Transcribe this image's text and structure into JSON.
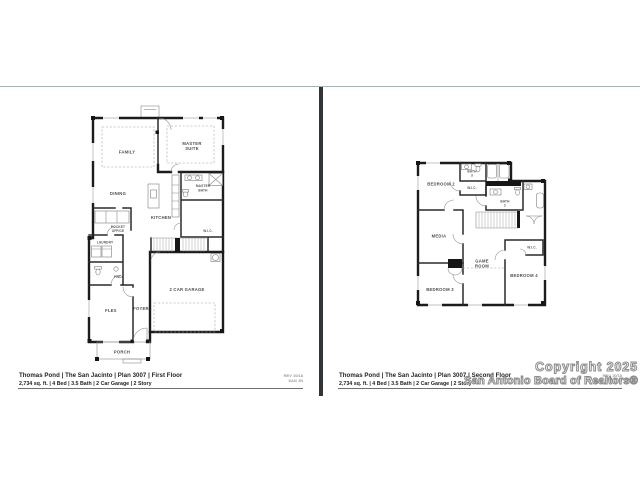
{
  "page": {
    "background": "#ffffff",
    "top_rule_color": "#a8b2b5",
    "divider_color": "#323537"
  },
  "watermark": {
    "line1": "Copyright 2025",
    "line2": "San Antonio Board of Realtors®"
  },
  "first_floor": {
    "footer": {
      "title": "Thomas Pond | The San Jacinto | Plan 3007 | First Floor",
      "specs": "2,734 sq. ft. | 4 Bed | 3.5 Bath | 2 Car Garage | 2 Story",
      "rev_line1": "REV 10/18",
      "rev_line2": "SAN JN"
    },
    "rooms": {
      "family": "FAMILY",
      "master_suite_l1": "MASTER",
      "master_suite_l2": "SUITE",
      "dining": "DINING",
      "kitchen": "KITCHEN",
      "master_bath_l1": "MASTER",
      "master_bath_l2": "BATH",
      "wic": "W.I.C.",
      "pocket_office_l1": "POCKET",
      "pocket_office_l2": "OFFICE",
      "laundry": "LAUNDRY",
      "powder": "PWDR",
      "flex": "FLEX",
      "foyer": "FOYER",
      "garage": "2 CAR GARAGE",
      "porch": "PORCH"
    }
  },
  "second_floor": {
    "footer": {
      "title": "Thomas Pond | The San Jacinto | Plan 3007 | Second Floor",
      "specs": "2,734 sq. ft. | 4 Bed | 3.5 Bath | 2 Car Garage | 2 Story",
      "rev_line1": "REV 10/18",
      "rev_line2": "SAN JN"
    },
    "rooms": {
      "bedroom2": "BEDROOM 2",
      "bath3_l1": "BATH",
      "bath3_l2": "3",
      "wic_top": "W.I.C.",
      "bath2_l1": "BATH",
      "bath2_l2": "2",
      "media": "MEDIA",
      "game_l1": "GAME",
      "game_l2": "ROOM",
      "wic_right": "W.I.C.",
      "bedroom3": "BEDROOM 3",
      "bedroom4": "BEDROOM 4"
    }
  }
}
